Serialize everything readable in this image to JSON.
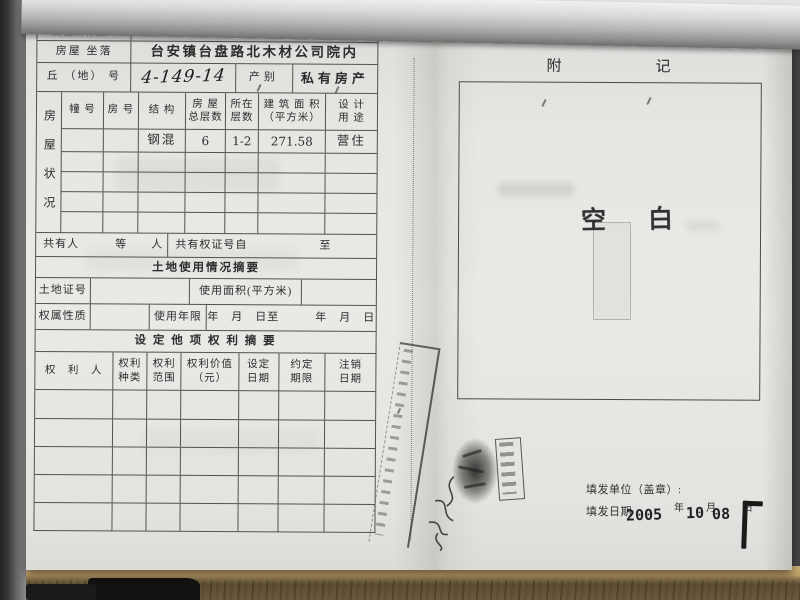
{
  "colors": {
    "paper": "#e8e7e3",
    "ink": "#2d2c2a",
    "stamp_ink": "#1b1a18",
    "desk_wood": "#6b583c",
    "background": "#3a3a3c"
  },
  "page_left": {
    "owner": {
      "label": "房屋所有权人",
      "name": "白建华"
    },
    "location": {
      "label": "房屋  坐落",
      "value": "台安镇台盘路北木材公司院内"
    },
    "plot": {
      "label": "丘 （地） 号",
      "number": "4-149-14",
      "category_label": "产别",
      "category_value": "私有房产"
    },
    "status": {
      "side_label": "房屋状况",
      "headers": [
        "幢  号",
        "房 号",
        "结  构",
        "房  屋\n总层数",
        "所在\n层数",
        "建 筑 面 积\n（平方米）",
        "设 计\n用 途"
      ],
      "row": {
        "structure": "钢混",
        "total_floors": "6",
        "floors": "1-2",
        "area": "271.58",
        "use": "营住"
      }
    },
    "co_owner": {
      "left": "共有人　　　等　　人",
      "right": "共有权证号自　　　　　　至"
    },
    "land": {
      "title": "土地使用情况摘要",
      "cert_label": "土地证号",
      "area_label": "使用面积(平方米)",
      "tenure_label": "权属性质",
      "years_label": "使用年限",
      "dates": "年　月　日至　　　年　月　日"
    },
    "rights": {
      "title": "设 定 他 项 权 利 摘 要",
      "headers": [
        "权　利　人",
        "权利\n种类",
        "权利\n范围",
        "权利价值\n（元）",
        "设定\n日期",
        "约定\n期限",
        "注销\n日期"
      ]
    }
  },
  "page_right": {
    "title_chars": [
      "附",
      "记"
    ],
    "blank_stamp_chars": [
      "空",
      "白"
    ],
    "issuer_label": "填发单位（盖章）:",
    "date_label": "填发日期",
    "date": {
      "year": "2005",
      "month": "10",
      "day": "08"
    },
    "units": {
      "year": "年",
      "month": "月",
      "day": "日"
    }
  }
}
